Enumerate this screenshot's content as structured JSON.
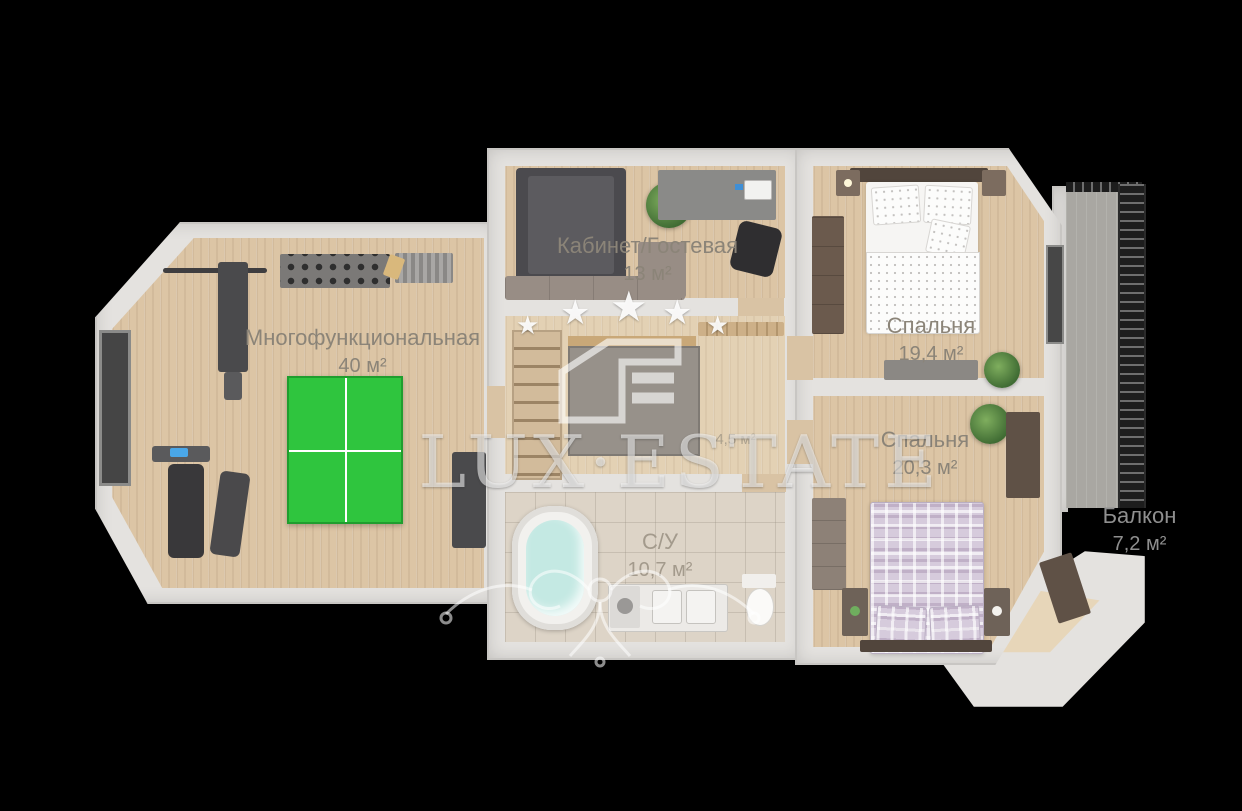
{
  "plan": {
    "rooms": [
      {
        "id": "multifunctional",
        "name": "Многофункциональная",
        "area": "40 м²"
      },
      {
        "id": "office-guest",
        "name": "Кабинет/Гостевая",
        "area": "13 м²"
      },
      {
        "id": "bedroom-1",
        "name": "Спальня",
        "area": "19,4 м²"
      },
      {
        "id": "bedroom-2",
        "name": "Спальня",
        "area": "20,3 м²"
      },
      {
        "id": "bathroom",
        "name": "С/У",
        "area": "10,7 м²"
      },
      {
        "id": "hall",
        "name": "",
        "area": "4,5 м²"
      },
      {
        "id": "balcony",
        "name": "Балкон",
        "area": "7,2 м²"
      }
    ]
  },
  "watermark": {
    "brand": "LUX·ESTATE",
    "star_icon": "★",
    "star_count": 5
  },
  "colors": {
    "background": "#000000",
    "wall": "#e4e2df",
    "wood_floor": "#dcc5a5",
    "tile_floor": "#ddd4c7",
    "pingpong_table": "#2fc53e",
    "tub_water": "#c4e9e3",
    "bed2_plaid": "#d6cbdc",
    "label_text": "#8b8478"
  }
}
